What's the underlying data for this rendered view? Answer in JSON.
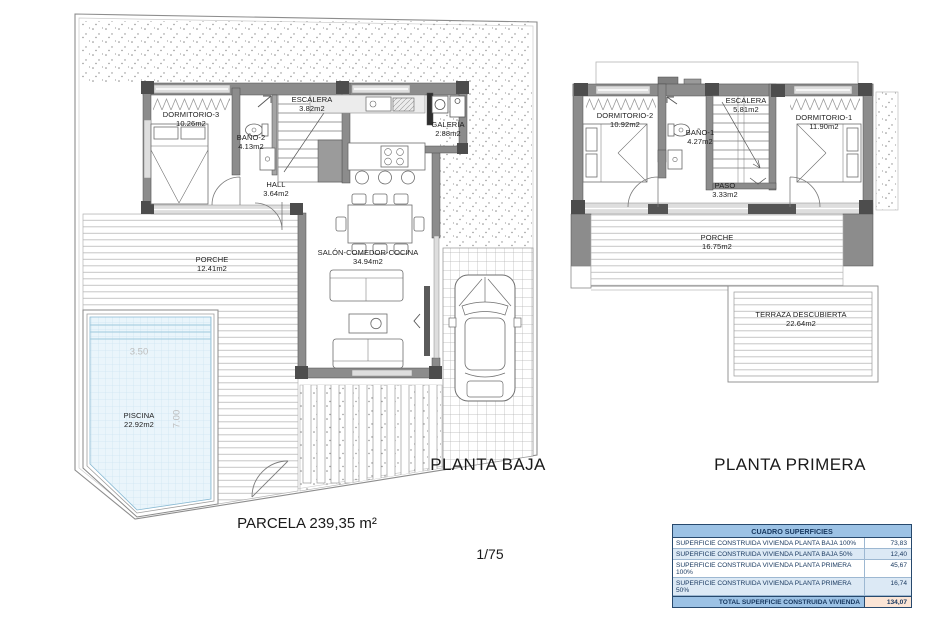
{
  "page": {
    "scale_label": "1/75",
    "parcel_label": "PARCELA 239,35 m²"
  },
  "plans": {
    "planta_baja": {
      "title": "PLANTA BAJA",
      "rooms": [
        {
          "name": "DORMITORIO-3",
          "area": "10.26m2"
        },
        {
          "name": "BAÑO-2",
          "area": "4.13m2"
        },
        {
          "name": "ESCALERA",
          "area": "3.82m2"
        },
        {
          "name": "GALERÍA",
          "area": "2.88m2"
        },
        {
          "name": "HALL",
          "area": "3.64m2"
        },
        {
          "name": "SALÓN-COMEDOR-COCINA",
          "area": "34.94m2"
        },
        {
          "name": "PORCHE",
          "area": "12.41m2"
        },
        {
          "name": "PISCINA",
          "area": "22.92m2"
        }
      ],
      "pool_dims": {
        "width": "3.50",
        "length": "7.00"
      }
    },
    "planta_primera": {
      "title": "PLANTA PRIMERA",
      "rooms": [
        {
          "name": "DORMITORIO-2",
          "area": "10.92m2"
        },
        {
          "name": "ESCALERA",
          "area": "5.81m2"
        },
        {
          "name": "DORMITORIO-1",
          "area": "11.90m2"
        },
        {
          "name": "BAÑO-1",
          "area": "4.27m2"
        },
        {
          "name": "PASO",
          "area": "3.33m2"
        },
        {
          "name": "PORCHE",
          "area": "16.75m2"
        },
        {
          "name": "TERRAZA DESCUBIERTA",
          "area": "22.64m2"
        }
      ]
    }
  },
  "surface_table": {
    "title": "CUADRO SUPERFICIES",
    "rows": [
      {
        "label": "SUPERFICIE CONSTRUIDA VIVIENDA PLANTA BAJA 100%",
        "value": "73,83"
      },
      {
        "label": "SUPERFICIE CONSTRUIDA VIVIENDA PLANTA BAJA 50%",
        "value": "12,40"
      },
      {
        "label": "SUPERFICIE CONSTRUIDA VIVIENDA PLANTA PRIMERA 100%",
        "value": "45,67"
      },
      {
        "label": "SUPERFICIE CONSTRUIDA VIVIENDA PLANTA PRIMERA 50%",
        "value": "16,74"
      }
    ],
    "total": {
      "label": "TOTAL SUPERFICIE CONSTRUIDA VIVIENDA",
      "value": "134,07"
    }
  },
  "colors": {
    "table_header_bg": "#9cc2e5",
    "table_alt_row_bg": "#dce9f5",
    "table_total_value_bg": "#fbe5d6",
    "table_text": "#17375e",
    "pool_water": "#eaf5fb",
    "wall_gray": "#8c8c8c"
  }
}
